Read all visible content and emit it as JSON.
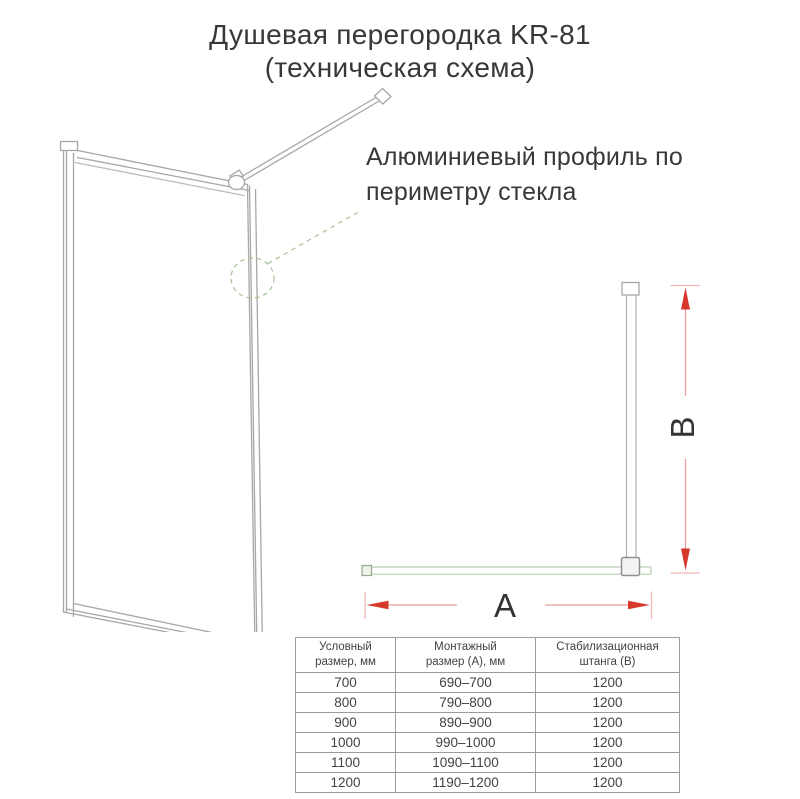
{
  "title": {
    "line1": "Душевая перегородка KR-81",
    "line2": "(техническая схема)"
  },
  "annotation": {
    "line1": "Алюминиевый профиль по",
    "line2": "периметру стекла"
  },
  "dimensions": {
    "width_label": "A",
    "height_label": "B"
  },
  "table": {
    "headers": [
      {
        "line1": "Условный",
        "line2": "размер, мм"
      },
      {
        "line1": "Монтажный",
        "line2": "размер (А), мм"
      },
      {
        "line1": "Стабилизационная",
        "line2": "штанга (В)"
      }
    ],
    "rows": [
      [
        "700",
        "690–700",
        "1200"
      ],
      [
        "800",
        "790–800",
        "1200"
      ],
      [
        "900",
        "890–900",
        "1200"
      ],
      [
        "1000",
        "990–1000",
        "1200"
      ],
      [
        "1100",
        "1090–1100",
        "1200"
      ],
      [
        "1200",
        "1190–1200",
        "1200"
      ]
    ]
  },
  "colors": {
    "red": "#d6382c",
    "red_soft": "#e9a29b",
    "red_tick": "#f2b6b0",
    "green_dash": "#a4c296",
    "glass_line": "#b8cfb2",
    "glass_cap": "#93aa8e",
    "line_gray": "#a7a7a7",
    "line_dark": "#8f8f8f",
    "text_color": "#383838",
    "table_border": "#9c9c9c"
  }
}
